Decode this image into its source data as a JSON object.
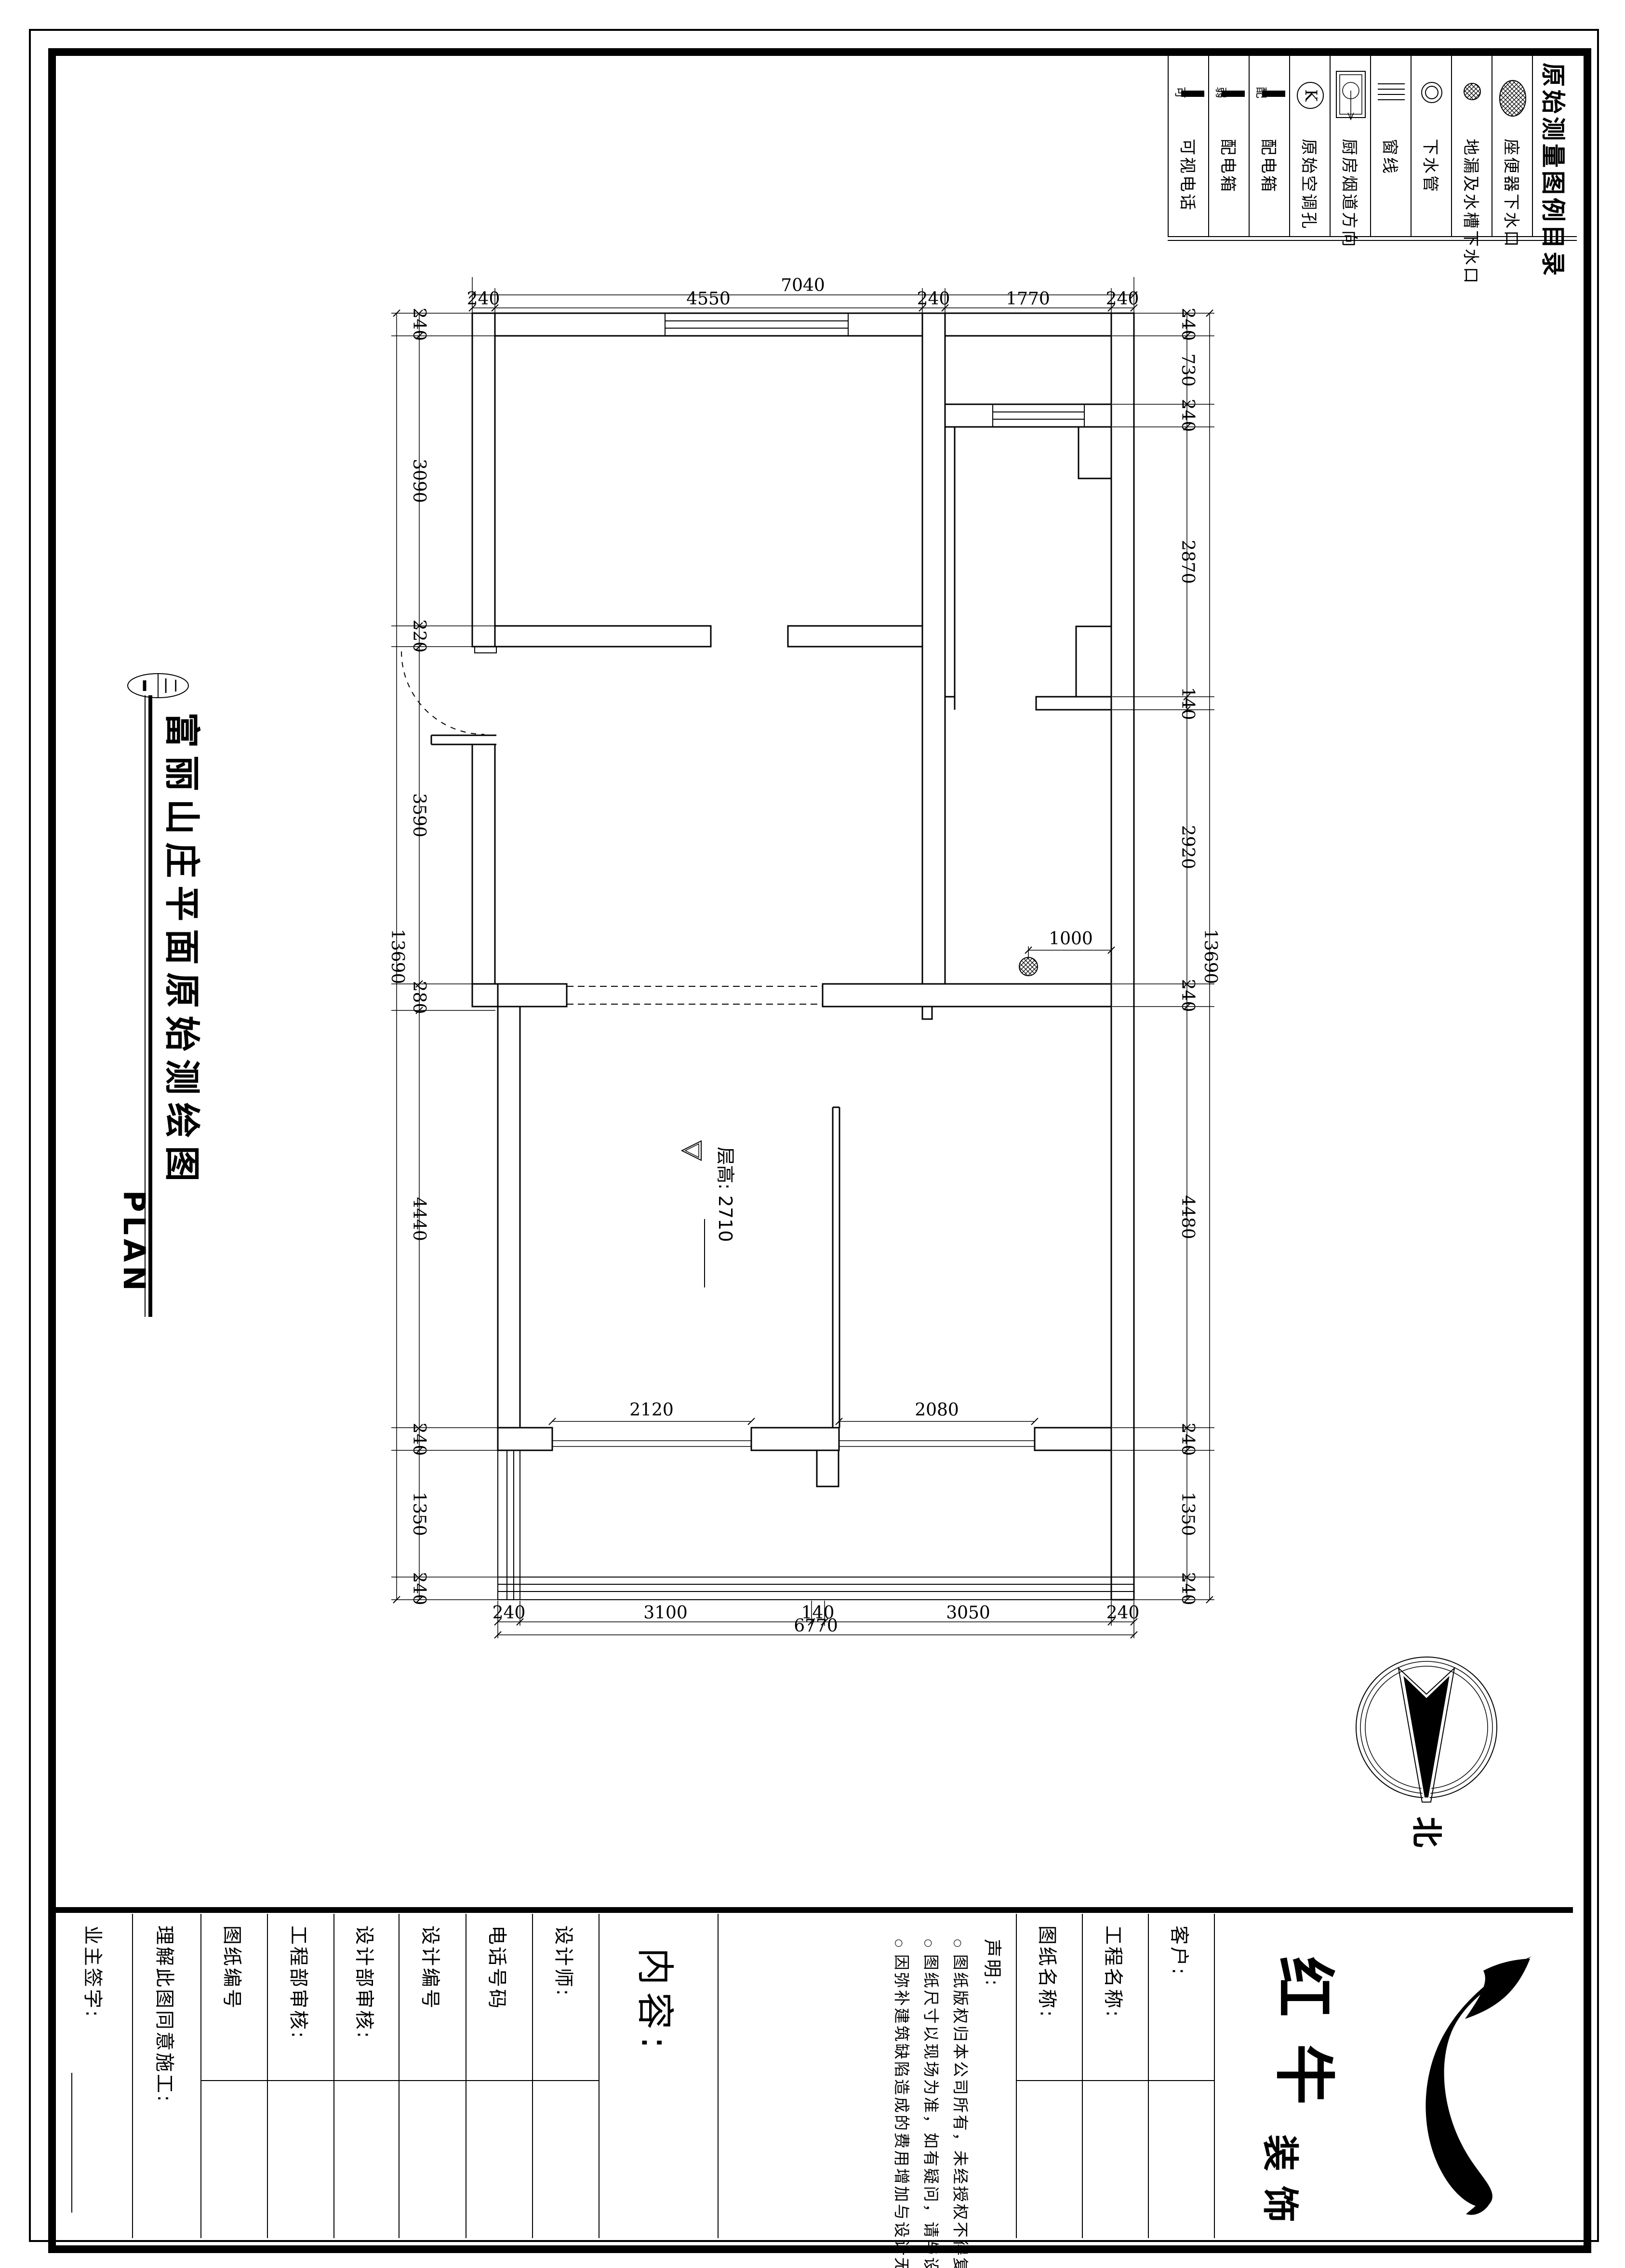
{
  "sheet": {
    "index_label": "二",
    "title": "富丽山庄平面原始测绘图",
    "subtitle": "PLAN",
    "north_label": "北"
  },
  "legend": {
    "title": "原始测量图例目录",
    "items": [
      {
        "label": "座便器下水口",
        "symbol": "toilet-drain"
      },
      {
        "label": "地漏及水槽下水口",
        "symbol": "floor-sink-drain"
      },
      {
        "label": "下水管",
        "symbol": "down-pipe"
      },
      {
        "label": "窗线",
        "symbol": "window-line"
      },
      {
        "label": "厨房烟道方向",
        "symbol": "kitchen-flue-direction"
      },
      {
        "label": "原始空调孔",
        "symbol": "original-ac-hole",
        "symbol_char": "K"
      },
      {
        "label": "配电箱",
        "symbol": "power-box",
        "symbol_char": "配"
      },
      {
        "label": "配电箱",
        "symbol": "weak-current-box",
        "symbol_char": "弱"
      },
      {
        "label": "可视电话",
        "symbol": "video-phone",
        "symbol_char": "可"
      }
    ]
  },
  "plan": {
    "floor_height_label": "层高: 2710",
    "dims": {
      "top_total": "7040",
      "top": [
        "240",
        "4550",
        "240",
        "1770",
        "240"
      ],
      "left_total": "13690",
      "left": [
        "240",
        "3090",
        "220",
        "3590",
        "280",
        "4440",
        "240",
        "1350",
        "240"
      ],
      "right": [
        "240",
        "730",
        "240",
        "2870",
        "140",
        "2920",
        "240",
        "4480",
        "240",
        "1350",
        "240"
      ],
      "right_total": "13690",
      "bottom": [
        "240",
        "3100",
        "140",
        "3050",
        "240"
      ],
      "bottom_total": "6770",
      "bath_drain": "1000",
      "left_opening": "2120",
      "right_opening": "2080"
    }
  },
  "title_block": {
    "owner_sign": "业主签字:",
    "agree": "理解此图同意施工:",
    "drawing_no": "图纸编号",
    "eng_review": "工程部审核:",
    "design_review": "设计部审核:",
    "design_no": "设计编号",
    "phone": "电话号码",
    "designer": "设计师:",
    "content": "内容:",
    "statement_title": "声明:",
    "statement_items": [
      "图纸版权归本公司所有，未经授权不得复印、转抄。",
      "图纸尺寸以现场为准，如有疑问，请与设计师联系，不可度量本图。",
      "因弥补建筑缺陷造成的费用增加与设计无关。"
    ],
    "drawing_name": "图纸名称:",
    "project_name": "工程名称:",
    "client": "客户:",
    "logo_main": "红牛",
    "logo_sub": "装饰"
  }
}
